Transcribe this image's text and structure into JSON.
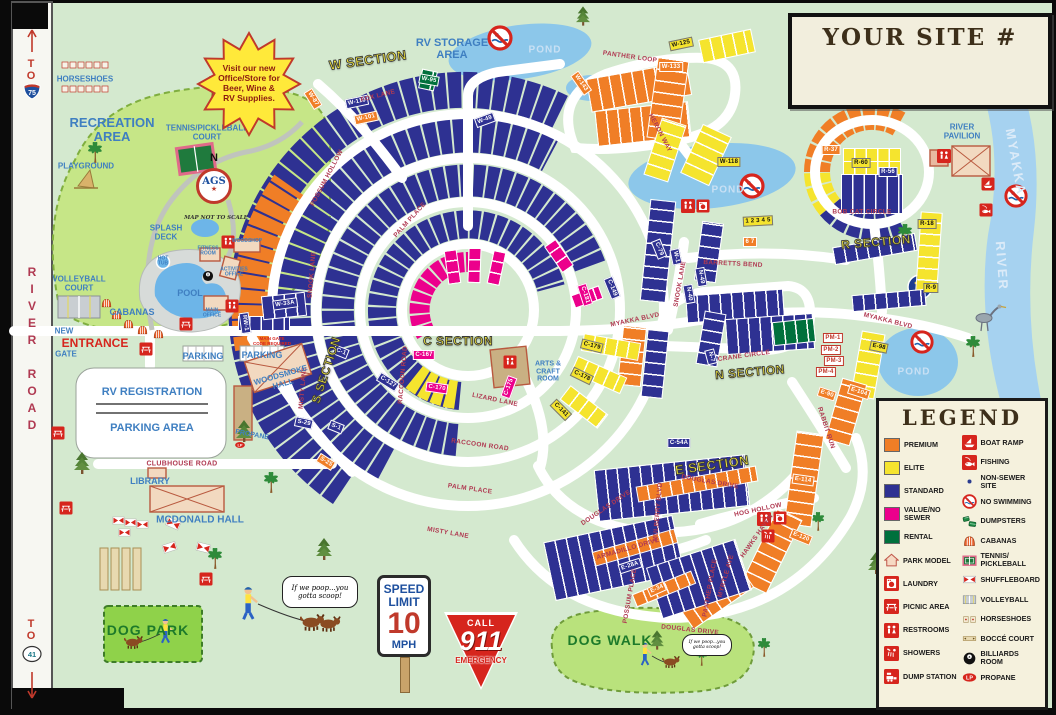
{
  "map_title_box": {
    "title": "YOUR SITE #"
  },
  "legend": {
    "title": "LEGEND",
    "left": [
      {
        "icon": "sw-premium",
        "label": "PREMIUM"
      },
      {
        "icon": "sw-elite",
        "label": "ELITE"
      },
      {
        "icon": "sw-standard",
        "label": "STANDARD"
      },
      {
        "icon": "sw-value_no_sewer",
        "label": "VALUE/NO\nSEWER"
      },
      {
        "icon": "sw-rental",
        "label": "RENTAL"
      },
      {
        "icon": "park-model",
        "label": "PARK MODEL"
      },
      {
        "icon": "laundry",
        "label": "LAUNDRY"
      },
      {
        "icon": "picnic",
        "label": "PICNIC AREA"
      },
      {
        "icon": "restrooms",
        "label": "RESTROOMS"
      },
      {
        "icon": "showers",
        "label": "SHOWERS"
      },
      {
        "icon": "dump",
        "label": "DUMP STATION"
      }
    ],
    "right": [
      {
        "icon": "boat-ramp",
        "label": "BOAT RAMP"
      },
      {
        "icon": "fishing",
        "label": "FISHING"
      },
      {
        "icon": "nonsewer",
        "label": "NON-SEWER SITE"
      },
      {
        "icon": "no-swim",
        "label": "NO SWIMMING"
      },
      {
        "icon": "dumpsters",
        "label": "DUMPSTERS"
      },
      {
        "icon": "cabanas",
        "label": "CABANAS"
      },
      {
        "icon": "tennis",
        "label": "TENNIS/\nPICKLEBALL"
      },
      {
        "icon": "shuffleboard",
        "label": "SHUFFLEBOARD"
      },
      {
        "icon": "volleyball",
        "label": "VOLLEYBALL"
      },
      {
        "icon": "horseshoes",
        "label": "HORSESHOES"
      },
      {
        "icon": "bocce",
        "label": "BOCCÉ COURT"
      },
      {
        "icon": "billiards",
        "label": "BILLIARDS ROOM"
      },
      {
        "icon": "propane",
        "label": "PROPANE"
      }
    ]
  },
  "colors": {
    "premium": "#F07E26",
    "elite": "#F5E42E",
    "standard": "#2E3192",
    "value_no_sewer": "#EC008C",
    "rental": "#00703C",
    "road_white": "#FFFFFF",
    "water_blue": "#8CC7EA",
    "river_blue": "#A6D2F0",
    "map_green": "#D4E9CF",
    "rec_green": "#C6E687",
    "sign_red": "#D6251D",
    "label_blue": "#3F7FC1",
    "road_name_red": "#B03A52",
    "section_yellow": "#F9ED38"
  },
  "sections": {
    "w": "W SECTION",
    "c": "C SECTION",
    "s": "S SECTION",
    "e": "E SECTION",
    "n": "N SECTION",
    "r": "R SECTION"
  },
  "roads": {
    "fox_lane": "FOX LANE",
    "snook_lane_a": "SNOOK LANE",
    "snook_lane_b": "SNOOK LANE",
    "possum_hollow": "POSSUM HOLLOW",
    "palm_place_a": "PALM PLACE",
    "palm_place_b": "PALM PLACE",
    "raccoon_road_a": "RACCOON ROAD",
    "raccoon_road_b": "RACCOON ROAD",
    "lizard_lane": "LIZARD LANE",
    "misty_lane_a": "MISTY LANE",
    "misty_lane_b": "MISTY LANE",
    "myakka_blvd_a": "MYAKKA BLVD",
    "myakka_blvd_b": "MYAKKA BLVD",
    "panther_loop": "PANTHER LOOP",
    "heron_way": "HERON WAY",
    "barretts_bend": "BARRETTS BEND",
    "bob_cat_circle": "BOB CAT CIRCLE",
    "crane_circle": "CRANE CIRCLE",
    "rabbit_run": "RABBIT RUN",
    "douglas_drive_a": "DOUGLAS DRIVE",
    "douglas_drive_b": "DOUGLAS DRIVE",
    "douglas_drive_c": "DOUGLAS DRIVE",
    "armadillo_drive": "ARMADILLO DRIVE",
    "hog_hollow": "HOG HOLLOW",
    "possum_place": "POSSUM PLACE",
    "panther_place": "PANTHER PLACE",
    "myrtle_ave": "MYRTLE AVE",
    "hawks_haven": "HAWKS HAVEN",
    "mulberry_blvd": "MULBERRY BLVD",
    "clubhouse_road": "CLUBHOUSE ROAD",
    "river_road": "RIVER ROAD"
  },
  "amenities": {
    "recreation_area": "RECREATION\nAREA",
    "horseshoes": "HORSESHOES",
    "playground": "PLAYGROUND",
    "tennis_court": "TENNIS/PICKLEBALL\nCOURT",
    "splash_deck": "SPLASH\nDECK",
    "hot_tub": "HOT\nTUB",
    "pool": "POOL",
    "cabanas": "CABANAS",
    "volleyball_court": "VOLLEYBALL\nCOURT",
    "main_office": "MAIN\nOFFICE",
    "fitness_room": "FITNESS\nROOM",
    "woodshop": "WOODSHOP",
    "activities_office": "ACTIVITIES\nOFFICE",
    "arts_craft_room": "ARTS &\nCRAFT\nROOM",
    "rv_storage": "RV STORAGE\nAREA",
    "pond_a": "POND",
    "pond_b": "POND",
    "pond_c": "POND",
    "river_pavilion": "RIVER\nPAVILION",
    "new_gate": "NEW",
    "entrance": "ENTRANCE",
    "gate": "GATE",
    "parking_a": "PARKING",
    "parking_b": "PARKING",
    "rv_registration": "RV REGISTRATION",
    "parking_area": "PARKING AREA",
    "library": "LIBRARY",
    "mcdonald_hall": "MCDONALD HALL",
    "woodsmoke_hall": "WOODSMOKE\nHALL",
    "propane": "PROPANE",
    "dog_park": "DOG PARK",
    "dog_walk": "DOG WALK",
    "main_gate_note": "MAIN GATE\nCODE REQUIRED",
    "myakka": "MYAKKA",
    "river": "RIVER"
  },
  "signs": {
    "speed_limit": {
      "line1": "SPEED",
      "line2": "LIMIT",
      "value": "10",
      "unit": "MPH"
    },
    "emergency": {
      "call": "CALL",
      "number": "911",
      "label": "EMERGENCY"
    },
    "office_burst": "Visit our new\nOffice/Store for\nBeer, Wine &\nRV Supplies.",
    "scoop_bubble_a": "If we poop...you\ngotta scoop!",
    "scoop_bubble_b": "If we poop...you\ngotta scoop!",
    "compass": {
      "north": "N",
      "center": "AGS",
      "note": "MAP NOT TO SCALE"
    }
  },
  "highways": {
    "top": {
      "prefix": "TO",
      "shield": "75"
    },
    "bottom": {
      "prefix": "TO",
      "shield": "41"
    }
  },
  "site_ranges": {
    "w": "W-1 – W-49, W-50 – W-98, W-101 – W-110, W-114 – W-125, W-127 – W-143, W-32A, W-33A, RW-1 – RW-4",
    "c": "C-1 – C-54A, C-58 – C-164, C-166 – C-187",
    "s": "S-1 – S-32A",
    "n": "N-1 – N-55, PM-1 – PM-4",
    "e": "E-24 – E-126",
    "r": "R-1 – R-65, 1 – 7"
  },
  "site_tags": [
    "W-49",
    "W-95",
    "W-87",
    "W-110",
    "W-101",
    "W-143",
    "W-133",
    "W-125",
    "W-118",
    "W-1",
    "W-33A",
    "RW-1",
    "C-179",
    "C-178",
    "C-141",
    "C-167",
    "C-170",
    "C-175",
    "C-181",
    "C-149",
    "C-54A",
    "C-1",
    "C-127",
    "S-1",
    "S-29",
    "S-25",
    "N-7",
    "N-40",
    "N-49",
    "C-79",
    "PM-1",
    "PM-2",
    "PM-3",
    "PM-4",
    "E-98",
    "E-90",
    "E-104",
    "E-114",
    "E-120",
    "E-28A",
    "E-34",
    "R-60",
    "R-56",
    "R-37",
    "R-9",
    "R-18",
    "1 2 3 4 5",
    "6 7"
  ]
}
